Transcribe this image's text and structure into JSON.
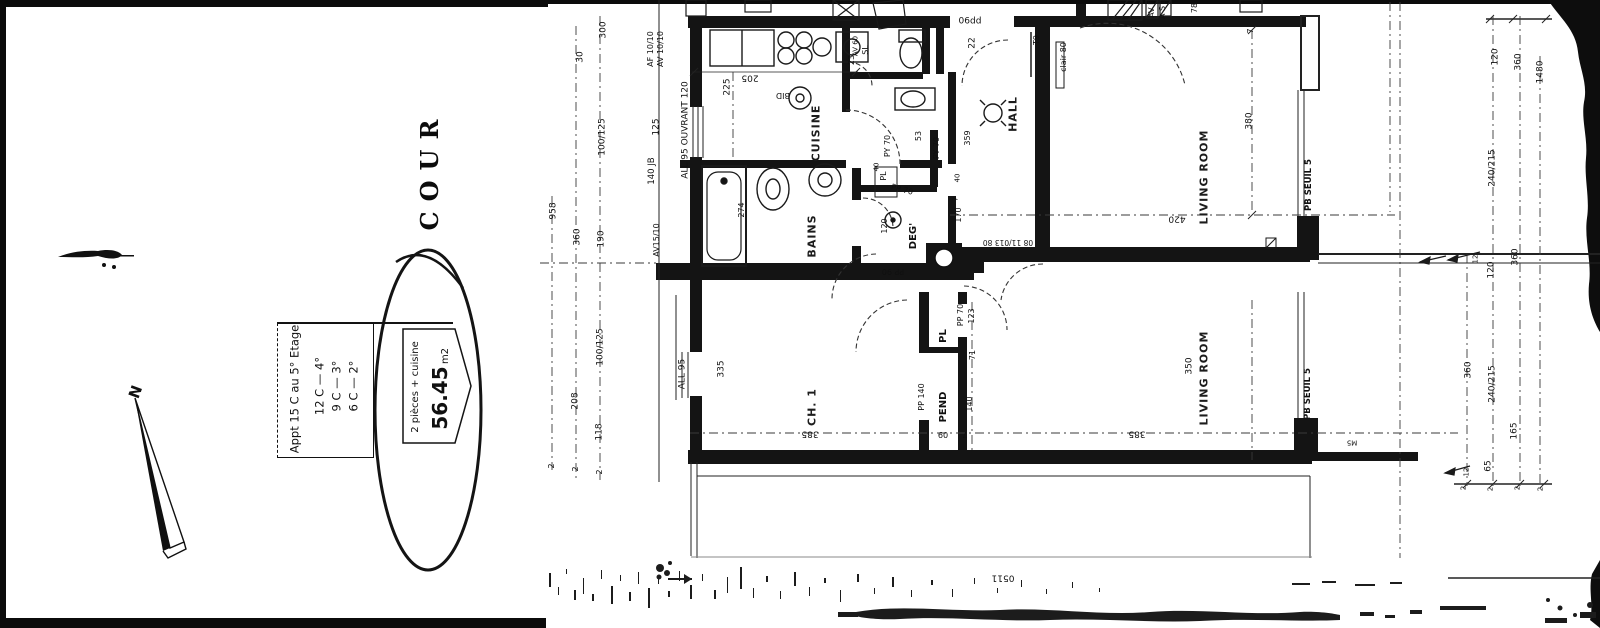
{
  "page": {
    "kind_label": "scanned floor plan",
    "ink_color": "#141414",
    "paper_color": "#ffffff"
  },
  "labels": {
    "cour": "COUR",
    "north": "N"
  },
  "info": {
    "l1": "Appt 15 C au 5° Etage",
    "l2": "12 C — 4°",
    "l3": "9 C — 3°",
    "l4": "6 C — 2°",
    "type": "2 pièces + cuisine",
    "area": "56.45",
    "unit": "m2"
  },
  "rooms": {
    "cuisine": "CUISINE",
    "bains": "BAINS",
    "hall": "HALL",
    "living_top": "LIVING ROOM",
    "living_bottom": "LIVING ROOM",
    "ch1": "CH. 1",
    "pend": "PEND",
    "pl": "PL",
    "deg": "DEG'",
    "seuil_top": "PB SEUIL 5",
    "seuil_bottom": "PB SEUIL 5"
  },
  "fx": {
    "bid": "BID",
    "ep": "EP",
    "t9": "T9",
    "clair": "clair 80",
    "o6dd": "06dd",
    "o511": "0511",
    "avf": "AV F",
    "asl": "A S L",
    "sl": "SL",
    "av60": "AV 60",
    "m5": "M5",
    "mark08": "08 11/013 80"
  },
  "dims": {
    "n300": "300",
    "n30": "30",
    "af": "AF 10/10",
    "av10": "AV 10/10",
    "n100_125": "100/125",
    "n125": "125",
    "jb": "140 JB",
    "all95o": "ALL 95 OUVRANT 120",
    "all95": "ALL 95",
    "n958": "958",
    "n360": "360",
    "n190": "190",
    "av15": "AV15/10",
    "n208": "208",
    "n118": "118",
    "n335": "335",
    "n2": "2",
    "n205": "205",
    "n225": "225",
    "n23": "23",
    "n274": "274",
    "n53": "53",
    "py70": "PY 70",
    "pp70": "PP 70",
    "pp90": "PP 90",
    "pl40": "40",
    "n120": "120",
    "n359": "359",
    "n40": "40",
    "n7": "7",
    "n170": "170",
    "n22": "22",
    "n78": "78",
    "n380": "380",
    "n420": "420",
    "n385": "385",
    "n350": "350",
    "pp140": "PP 140",
    "n123": "123",
    "n140": "140",
    "n71": "71",
    "n09": "09",
    "n12": "12",
    "n1480": "1480",
    "n240_215": "240/215",
    "n165": "165",
    "n65": "65"
  }
}
